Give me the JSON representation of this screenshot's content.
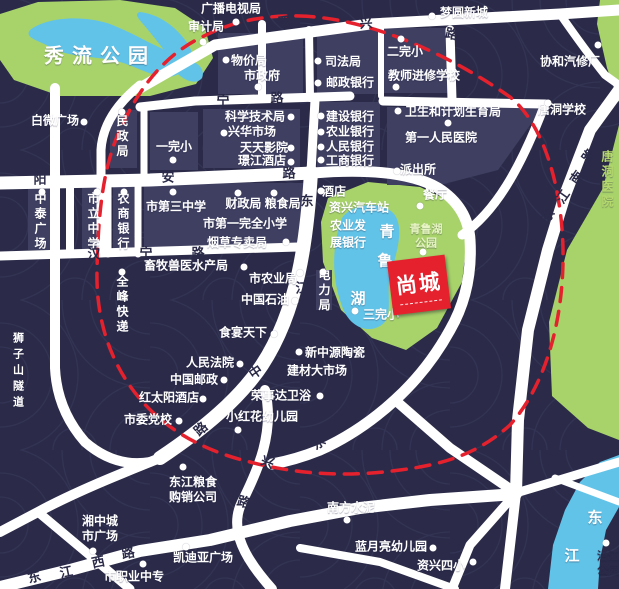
{
  "map": {
    "title": "尚城项目区位图",
    "colors": {
      "background": "#2b2b49",
      "texture_line": "#3a3a5e",
      "block": "#3f3f62",
      "road": "#ffffff",
      "park": "#a8d36b",
      "water": "#62c3e8",
      "boundary_red": "#e5212e",
      "logo_red": "#e5212e",
      "label_white": "#ffffff",
      "road_char": "#2b2b49"
    },
    "logo": {
      "text": "尚城"
    },
    "parks": [
      {
        "id": "xiuliu-park-area",
        "points": "0,14 38,2 120,0 175,8 205,28 213,58 196,84 150,96 60,96 14,80 0,60"
      },
      {
        "id": "qingluhu-park-area",
        "points": "328,198 368,182 420,187 452,202 468,232 462,282 437,328 406,350 372,338 341,310 323,262 321,222"
      },
      {
        "id": "east-green-area",
        "points": "619,125 603,188 567,250 549,322 552,396 588,428 619,440"
      },
      {
        "id": "topright-green-area",
        "points": "600,0 619,0 619,102 607,68 597,24"
      }
    ],
    "waters": [
      {
        "id": "xiuliu-lake",
        "d": "M30,30 C45,18 80,14 110,24 C135,34 150,44 170,52 C185,58 186,72 174,76 C158,80 140,68 120,62 C100,56 70,58 52,48 C38,40 24,38 30,30 Z M140,12 C158,14 176,26 188,44 C196,56 192,70 182,66 C170,60 160,44 148,30 C142,22 132,14 140,12 Z M180,58 C196,60 206,68 202,78 C196,86 182,80 174,70 Z"
      },
      {
        "id": "qinglu-lake",
        "d": "M342,218 C352,203 382,200 394,214 C404,226 398,252 390,274 C386,294 393,310 384,323 C369,336 349,327 342,306 C332,280 331,248 342,218 Z"
      },
      {
        "id": "dongjiang-river",
        "d": "M619,455 L600,462 L580,482 L565,510 L553,545 L548,589 L598,589 L600,560 L606,530 L619,507 Z"
      }
    ],
    "blocks": [
      "218,33 303,33 303,94 218,94",
      "317,30 378,30 378,94 317,94",
      "383,28 448,28 448,93 383,93",
      "203,109 300,109 300,168 203,168",
      "317,102 380,102 380,168 317,168",
      "110,110 137,110 137,168 110,168",
      "150,112 198,112 198,170 150,170",
      "387,107 543,107 498,170 440,185 387,185",
      "28,185 58,185 58,250 28,250",
      "82,183 103,183 103,251 82,251",
      "113,183 134,183 134,251 113,251",
      "144,183 310,183 306,247 144,247",
      "316,270 332,270 332,310 316,310"
    ],
    "roads": [
      {
        "d": "M140,88 L215,45 L370,24 L560,14 L619,10",
        "w": 11
      },
      {
        "d": "M560,14 Q585,50 605,75 L619,85",
        "w": 8
      },
      {
        "d": "M450,30 L452,100",
        "w": 9
      },
      {
        "d": "M140,107 L195,101 L350,96",
        "w": 9
      },
      {
        "d": "M262,24 L262,98",
        "w": 8
      },
      {
        "d": "M309,30 L310,98",
        "w": 8
      },
      {
        "d": "M381,28 L381,96",
        "w": 6
      },
      {
        "d": "M0,183 L150,180 L313,173",
        "w": 13
      },
      {
        "d": "M313,173 Q400,166 438,188 Q468,207 470,240 Q473,290 450,330 Q428,370 395,400 Q360,432 320,450 Q295,460 272,464",
        "w": 11
      },
      {
        "d": "M140,85 Q103,115 101,150 L101,253",
        "w": 9
      },
      {
        "d": "M144,110 L144,176",
        "w": 7
      },
      {
        "d": "M0,256 L298,247",
        "w": 9
      },
      {
        "d": "M70,181 L70,254",
        "w": 8
      },
      {
        "d": "M108,181 L108,254",
        "w": 7
      },
      {
        "d": "M138,183 L138,254",
        "w": 7
      },
      {
        "d": "M311,172 C307,240 298,310 262,365 C240,398 205,428 160,458",
        "w": 14
      },
      {
        "d": "M315,100 L311,172",
        "w": 9
      },
      {
        "d": "M55,88 L55,368 Q57,410 85,442 Q115,468 150,462",
        "w": 10
      },
      {
        "d": "M160,458 C120,474 75,492 38,512 L0,532",
        "w": 10
      },
      {
        "d": "M38,512 L130,589",
        "w": 9
      },
      {
        "d": "M0,587 L70,570 L140,551 L210,540 L290,521 L360,508 L430,500 L516,494",
        "w": 12
      },
      {
        "d": "M265,390 C275,432 258,470 242,502 C228,530 246,560 272,589",
        "w": 10
      },
      {
        "d": "M395,400 L450,448 L516,493",
        "w": 10
      },
      {
        "d": "M619,90 L590,130 L565,195 L548,250 L528,330 L518,420 L516,493",
        "w": 12
      },
      {
        "d": "M516,493 L619,462",
        "w": 9
      },
      {
        "d": "M516,493 L505,589",
        "w": 10
      },
      {
        "d": "M516,493 L470,545 L452,589",
        "w": 9
      },
      {
        "d": "M300,548 L380,562 L455,589",
        "w": 8
      },
      {
        "d": "M555,478 L619,502",
        "w": 7
      },
      {
        "d": "M383,101 L545,104",
        "w": 9
      },
      {
        "d": "M545,104 C520,170 495,212 462,235",
        "w": 9
      }
    ],
    "boundary": {
      "d": "M300,16 C370,18 450,55 510,97 C545,125 562,190 563,250 C564,310 550,380 510,425 C480,452 448,464 400,470 C350,477 300,475 250,462 C200,450 158,426 130,386 C105,350 96,310 97,270 C98,220 102,168 120,130 C136,94 160,58 200,38 C232,21 265,15 300,16 Z",
      "dash": "14 10",
      "width": 3.5
    },
    "labels": [
      {
        "id": "xiuliu-park",
        "t": "秀流公园",
        "x": 100,
        "y": 57,
        "s": 20,
        "ls": 8
      },
      {
        "id": "guangbo-dianshiju",
        "t": "广播电视局",
        "x": 231,
        "y": 9
      },
      {
        "id": "shenjiju",
        "t": "审计局",
        "x": 206,
        "y": 27
      },
      {
        "id": "mengyuan-xincheng",
        "t": "梦圆新城",
        "x": 464,
        "y": 13
      },
      {
        "id": "wujiaju",
        "t": "物价局",
        "x": 249,
        "y": 61
      },
      {
        "id": "shizhengfu",
        "t": "市政府",
        "x": 262,
        "y": 76
      },
      {
        "id": "sifaju",
        "t": "司法局",
        "x": 343,
        "y": 62
      },
      {
        "id": "youzheng-bank",
        "t": "邮政银行",
        "x": 350,
        "y": 83
      },
      {
        "id": "erwanxiao",
        "t": "二完小",
        "x": 405,
        "y": 52
      },
      {
        "id": "jiaoshi-school",
        "t": "教师进修学校",
        "x": 424,
        "y": 76
      },
      {
        "id": "xiehe-qixiuchang",
        "t": "协和汽修厂",
        "x": 570,
        "y": 62
      },
      {
        "id": "tangdong-school",
        "t": "唐洞学校",
        "x": 562,
        "y": 110
      },
      {
        "id": "baiwei-plaza",
        "t": "白微广场",
        "x": 55,
        "y": 121
      },
      {
        "id": "minzhengju",
        "t": "民政局",
        "x": 122,
        "y": 137,
        "v": 1
      },
      {
        "id": "yiwanxiao",
        "t": "一完小",
        "x": 174,
        "y": 147
      },
      {
        "id": "weisheng-jihua",
        "t": "卫生和计划生育局",
        "x": 453,
        "y": 112
      },
      {
        "id": "diyi-hospital",
        "t": "第一人民医院",
        "x": 441,
        "y": 138
      },
      {
        "id": "paichusuo",
        "t": "派出所",
        "x": 418,
        "y": 170
      },
      {
        "id": "canting",
        "t": "餐厅",
        "x": 435,
        "y": 195
      },
      {
        "id": "kexue-jishuju",
        "t": "科学技术局",
        "x": 255,
        "y": 117
      },
      {
        "id": "xinghua-market",
        "t": "兴华市场",
        "x": 252,
        "y": 132
      },
      {
        "id": "tiantian-cinema",
        "t": "天天影院",
        "x": 264,
        "y": 148
      },
      {
        "id": "jingjiang-hotel",
        "t": "璟江酒店",
        "x": 262,
        "y": 161
      },
      {
        "id": "jianshe-bank",
        "t": "建设银行",
        "x": 350,
        "y": 117
      },
      {
        "id": "nongye-bank",
        "t": "农业银行",
        "x": 350,
        "y": 132
      },
      {
        "id": "renmin-bank",
        "t": "人民银行",
        "x": 350,
        "y": 147
      },
      {
        "id": "gongshang-bank",
        "t": "工商银行",
        "x": 350,
        "y": 161
      },
      {
        "id": "tangdong-hospital",
        "t": "唐洞医院",
        "x": 607,
        "y": 180,
        "v": 1,
        "c": "#b5d86e"
      },
      {
        "id": "zhongtai-plaza",
        "t": "中泰广场",
        "x": 40,
        "y": 222,
        "v": 1
      },
      {
        "id": "shili-school",
        "t": "市立中学",
        "x": 93,
        "y": 222,
        "v": 1
      },
      {
        "id": "nongshang-bank",
        "t": "农商银行",
        "x": 123,
        "y": 222,
        "v": 1
      },
      {
        "id": "no3-middle-school",
        "t": "市第三中学",
        "x": 176,
        "y": 207
      },
      {
        "id": "caizhengju-liangshiju",
        "t": "财政局 粮食局",
        "x": 263,
        "y": 204
      },
      {
        "id": "no1-primary",
        "t": "市第一完全小学",
        "x": 245,
        "y": 224
      },
      {
        "id": "yancao-zhuanmaiju",
        "t": "烟草专卖局",
        "x": 237,
        "y": 243
      },
      {
        "id": "xumu-shouyi",
        "t": "畜牧兽医水产局",
        "x": 186,
        "y": 266
      },
      {
        "id": "quanfeng-express",
        "t": "全峰快递",
        "x": 122,
        "y": 305,
        "v": 1
      },
      {
        "id": "shizishan-tunnel",
        "t": "狮子山隧道",
        "x": 17,
        "y": 372,
        "v": 1,
        "s": 11,
        "ls": 5
      },
      {
        "id": "shi-nongyeju",
        "t": "市农业局",
        "x": 273,
        "y": 279
      },
      {
        "id": "zhongguo-shiyou",
        "t": "中国石油",
        "x": 265,
        "y": 300
      },
      {
        "id": "dianliju",
        "t": "电力局",
        "x": 324,
        "y": 291,
        "v": 1
      },
      {
        "id": "shiyan-tianxia",
        "t": "食宴天下",
        "x": 243,
        "y": 333
      },
      {
        "id": "jiudian",
        "t": "酒店",
        "x": 334,
        "y": 192
      },
      {
        "id": "zixing-bus-station",
        "t": "资兴汽车站",
        "x": 359,
        "y": 208
      },
      {
        "id": "nongyefa",
        "t": "农业发",
        "x": 348,
        "y": 226
      },
      {
        "id": "zhanyinhang",
        "t": "展银行",
        "x": 348,
        "y": 243
      },
      {
        "id": "qingluhu-park",
        "t": "青鲁湖\n公园",
        "x": 426,
        "y": 237,
        "s": 11,
        "c": "#e7f4c4"
      },
      {
        "id": "lake-char-qing",
        "t": "青",
        "x": 387,
        "y": 233,
        "s": 15
      },
      {
        "id": "lake-char-lu",
        "t": "鲁",
        "x": 385,
        "y": 262,
        "s": 15
      },
      {
        "id": "lake-char-hu",
        "t": "湖",
        "x": 358,
        "y": 300,
        "s": 15
      },
      {
        "id": "sanwanxiao",
        "t": "三完小",
        "x": 381,
        "y": 315
      },
      {
        "id": "renmin-court",
        "t": "人民法院",
        "x": 210,
        "y": 363
      },
      {
        "id": "zhongguo-youzheng",
        "t": "中国邮政",
        "x": 194,
        "y": 380
      },
      {
        "id": "hongtaiyang-hotel",
        "t": "红太阳酒店",
        "x": 169,
        "y": 398
      },
      {
        "id": "shiwei-dangxiao",
        "t": "市委党校",
        "x": 148,
        "y": 420
      },
      {
        "id": "xinzhongyuan-taoci",
        "t": "新中源陶瓷",
        "x": 335,
        "y": 353
      },
      {
        "id": "jiancai-market",
        "t": "建材大市场",
        "x": 317,
        "y": 371
      },
      {
        "id": "rongshida-weiyu",
        "t": "荣事达卫浴",
        "x": 281,
        "y": 396
      },
      {
        "id": "xiaohonghua-kindergarten",
        "t": "小红花幼儿园",
        "x": 262,
        "y": 417
      },
      {
        "id": "dongjiang-grain",
        "t": "东江粮食\n购销公司",
        "x": 193,
        "y": 490
      },
      {
        "id": "xiangzhong-plaza",
        "t": "湘中城\n市广场",
        "x": 100,
        "y": 529
      },
      {
        "id": "kaidiya-plaza",
        "t": "凯迪亚广场",
        "x": 203,
        "y": 558
      },
      {
        "id": "shizhiye-zhongzhuan",
        "t": "市职业中专",
        "x": 134,
        "y": 577
      },
      {
        "id": "nanfang-shuini",
        "t": "南方水泥",
        "x": 351,
        "y": 508
      },
      {
        "id": "lanyueliang-kindergarten",
        "t": "蓝月亮幼儿园",
        "x": 391,
        "y": 547
      },
      {
        "id": "zixing-no4-primary",
        "t": "资兴四小",
        "x": 441,
        "y": 566
      },
      {
        "id": "river-char-dong",
        "t": "东",
        "x": 595,
        "y": 519,
        "s": 15
      },
      {
        "id": "river-char-jiang",
        "t": "江",
        "x": 572,
        "y": 557,
        "s": 15
      },
      {
        "id": "yanjiang-park",
        "t": "沿江\n公园",
        "x": 608,
        "y": 564,
        "s": 11,
        "c": "#2b2b49"
      }
    ],
    "road_chars": [
      {
        "t": "晋",
        "x": 284,
        "y": 21,
        "r": -8
      },
      {
        "t": "兴",
        "x": 366,
        "y": 22,
        "r": -4
      },
      {
        "t": "路",
        "x": 452,
        "y": 33,
        "r": 12
      },
      {
        "t": "宁",
        "x": 223,
        "y": 100,
        "r": 0
      },
      {
        "t": "路",
        "x": 277,
        "y": 97,
        "r": 0
      },
      {
        "t": "阳",
        "x": 40,
        "y": 178,
        "r": 0
      },
      {
        "t": "安",
        "x": 168,
        "y": 176,
        "r": 0
      },
      {
        "t": "路",
        "x": 289,
        "y": 172,
        "r": 0
      },
      {
        "t": "汉",
        "x": 94,
        "y": 253,
        "r": 0
      },
      {
        "t": "宁",
        "x": 146,
        "y": 252,
        "r": 0
      },
      {
        "t": "路",
        "x": 198,
        "y": 252,
        "r": 0
      },
      {
        "t": "东",
        "x": 307,
        "y": 200,
        "r": 0
      },
      {
        "t": "江",
        "x": 302,
        "y": 287,
        "r": 0
      },
      {
        "t": "中",
        "x": 255,
        "y": 371,
        "r": -35
      },
      {
        "t": "路",
        "x": 200,
        "y": 428,
        "r": -42
      },
      {
        "t": "东",
        "x": 34,
        "y": 576,
        "r": -15
      },
      {
        "t": "江",
        "x": 66,
        "y": 571,
        "r": -12
      },
      {
        "t": "西",
        "x": 98,
        "y": 561,
        "r": -12
      },
      {
        "t": "路",
        "x": 128,
        "y": 552,
        "r": -10
      },
      {
        "t": "路",
        "x": 588,
        "y": 155,
        "r": -55
      },
      {
        "t": "南",
        "x": 576,
        "y": 177,
        "r": -55
      },
      {
        "t": "江",
        "x": 562,
        "y": 196,
        "r": -55
      },
      {
        "t": "东",
        "x": 547,
        "y": 215,
        "r": -55
      },
      {
        "t": "兴",
        "x": 268,
        "y": 461,
        "r": 20
      },
      {
        "t": "路",
        "x": 244,
        "y": 501,
        "r": 15
      },
      {
        "t": "东",
        "x": 318,
        "y": 442,
        "r": -35
      }
    ],
    "dots": [
      [
        236,
        22
      ],
      [
        203,
        42
      ],
      [
        432,
        16
      ],
      [
        84,
        122
      ],
      [
        122,
        112
      ],
      [
        173,
        160
      ],
      [
        226,
        60
      ],
      [
        258,
        87
      ],
      [
        318,
        61
      ],
      [
        318,
        83
      ],
      [
        401,
        39
      ],
      [
        396,
        87
      ],
      [
        598,
        45
      ],
      [
        548,
        103
      ],
      [
        398,
        111
      ],
      [
        448,
        123
      ],
      [
        397,
        171
      ],
      [
        291,
        117
      ],
      [
        224,
        133
      ],
      [
        291,
        148
      ],
      [
        291,
        162
      ],
      [
        321,
        116
      ],
      [
        321,
        132
      ],
      [
        321,
        147
      ],
      [
        321,
        160
      ],
      [
        42,
        192
      ],
      [
        97,
        192
      ],
      [
        124,
        192
      ],
      [
        173,
        192
      ],
      [
        238,
        193
      ],
      [
        274,
        193
      ],
      [
        286,
        242
      ],
      [
        244,
        267
      ],
      [
        122,
        272
      ],
      [
        300,
        273
      ],
      [
        295,
        301
      ],
      [
        323,
        272
      ],
      [
        274,
        334
      ],
      [
        355,
        311
      ],
      [
        321,
        191
      ],
      [
        423,
        252
      ],
      [
        420,
        206
      ],
      [
        240,
        364
      ],
      [
        224,
        380
      ],
      [
        203,
        399
      ],
      [
        179,
        421
      ],
      [
        299,
        352
      ],
      [
        320,
        396
      ],
      [
        238,
        430
      ],
      [
        183,
        467
      ],
      [
        93,
        551
      ],
      [
        186,
        547
      ],
      [
        143,
        564
      ],
      [
        347,
        520
      ],
      [
        433,
        548
      ],
      [
        473,
        562
      ],
      [
        606,
        543
      ]
    ]
  }
}
